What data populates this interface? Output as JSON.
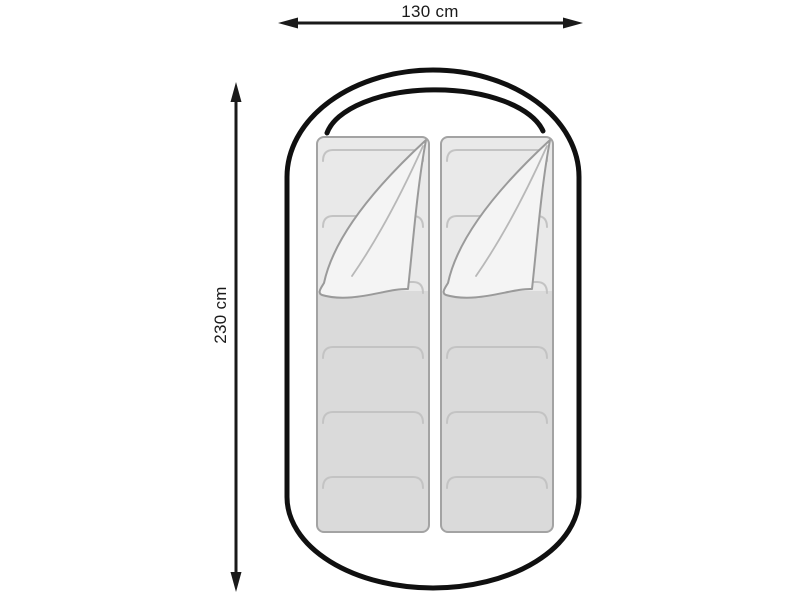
{
  "labels": {
    "width": "130 cm",
    "height": "230 cm"
  },
  "values": {
    "width_cm": 130,
    "height_cm": 230
  },
  "colors": {
    "background": "#ffffff",
    "outline": "#101010",
    "arrow": "#1a1a1a",
    "text": "#1a1a1a",
    "bag_border": "#a3a3a3",
    "bag_top": "#e9e9e9",
    "bag_bottom": "#dadada",
    "flap": "#f4f4f4",
    "flap_edge": "#9a9a9a",
    "seam": "#c3c3c3",
    "crease": "#b8b8b8"
  }
}
